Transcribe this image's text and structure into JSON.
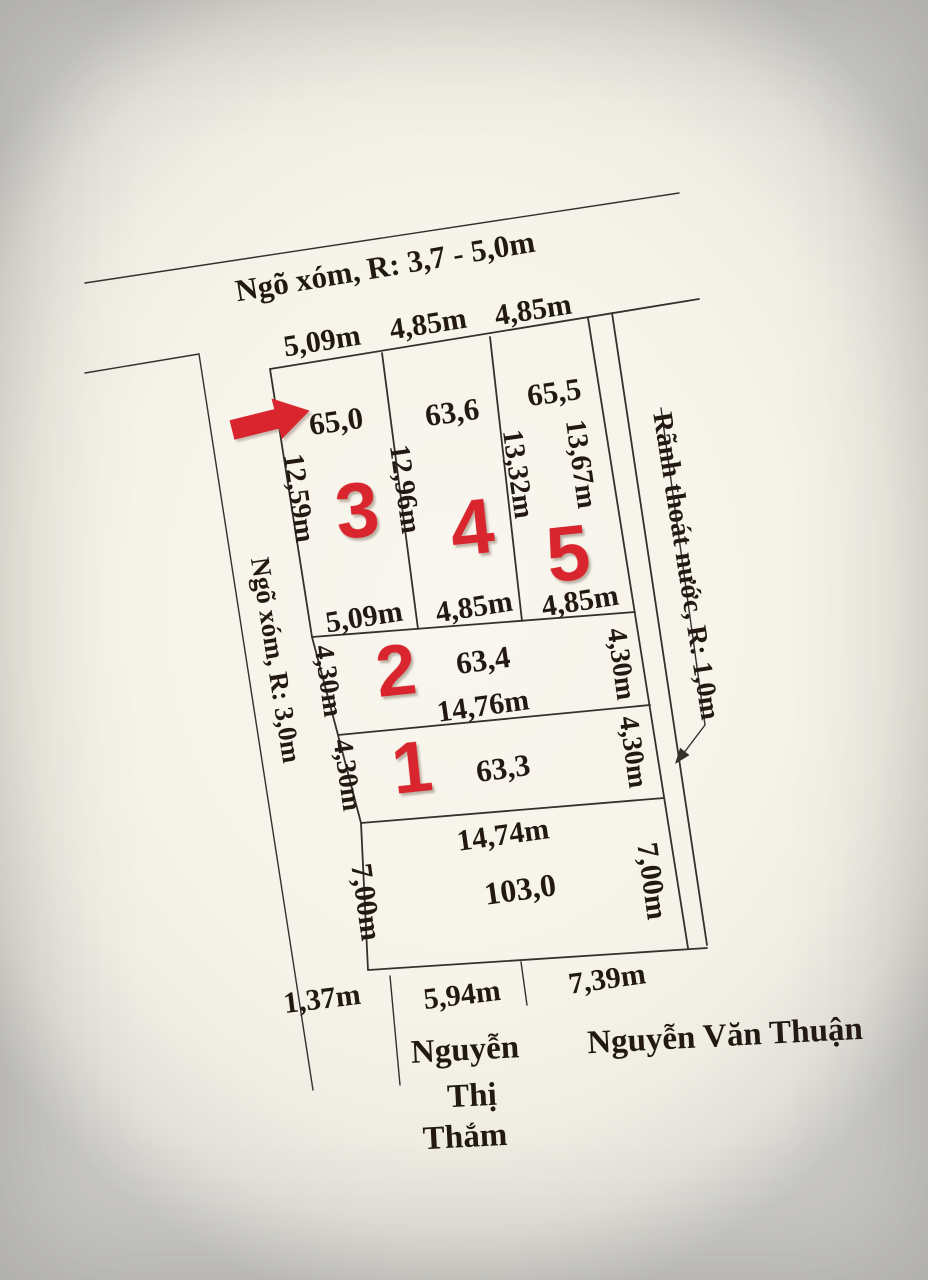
{
  "colors": {
    "paper": "#f6f3ea",
    "ink": "#221a12",
    "line": "#36302b",
    "accent_red": "#d9252d"
  },
  "roads": {
    "top": "Ngõ xóm, R: 3,7 - 5,0m",
    "left": "Ngõ xóm, R: 3,0m",
    "drainage": "Rãnh thoát nước, R: 1,0m"
  },
  "pointer": {
    "icon": "red-arrow-right",
    "target_plot": "3"
  },
  "top_row": {
    "top_widths": [
      "5,09m",
      "4,85m",
      "4,85m"
    ],
    "plots": [
      {
        "number": "3",
        "area": "65,0"
      },
      {
        "number": "4",
        "area": "63,6"
      },
      {
        "number": "5",
        "area": "65,5"
      }
    ],
    "side_lengths": [
      "12,59m",
      "12,96m",
      "13,32m",
      "13,67m"
    ],
    "bottom_widths": [
      "5,09m",
      "4,85m",
      "4,85m"
    ]
  },
  "plot2": {
    "number": "2",
    "area": "63,4",
    "bottom_width": "14,76m",
    "left_side": "4,30m",
    "right_side": "4,30m"
  },
  "plot1": {
    "number": "1",
    "area": "63,3",
    "left_side": "4,30m",
    "right_side": "4,30m"
  },
  "south_plot": {
    "area": "103,0",
    "top_width": "14,74m",
    "left_side": "7,00m",
    "right_side": "7,00m"
  },
  "south_boundary_segments": [
    "1,37m",
    "5,94m",
    "7,39m"
  ],
  "neighbors": {
    "south": [
      "Nguyễn",
      "Thị",
      "Thắm"
    ],
    "south_east": "Nguyễn Văn Thuận"
  }
}
